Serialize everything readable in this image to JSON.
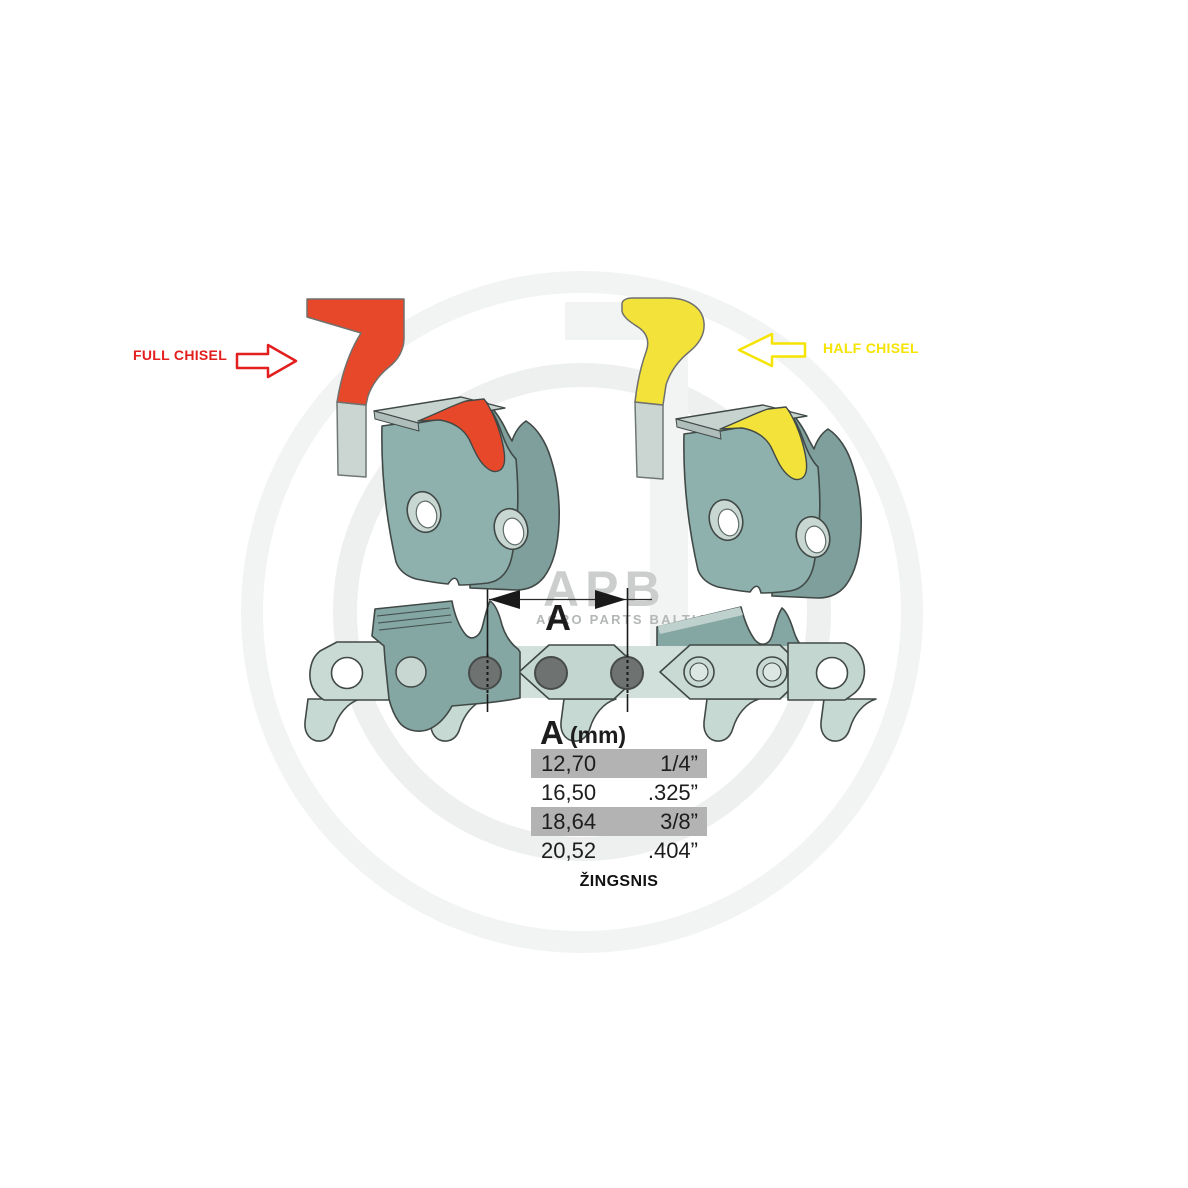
{
  "labels": {
    "full_chisel": "FULL CHISEL",
    "half_chisel": "HALF CHISEL",
    "dimension": "A",
    "pitch_caption": "ŽINGSNIS"
  },
  "watermark": {
    "logo": "APB",
    "subtitle": "AGRO PARTS BALTIJA"
  },
  "table": {
    "header": {
      "symbol": "A",
      "unit": "(mm)"
    },
    "columns": [
      "pitch_mm",
      "pitch_inch"
    ],
    "rows": [
      {
        "mm": "12,70",
        "inch": "1/4”",
        "highlighted": true
      },
      {
        "mm": "16,50",
        "inch": ".325”",
        "highlighted": false
      },
      {
        "mm": "18,64",
        "inch": "3/8”",
        "highlighted": true
      },
      {
        "mm": "20,52",
        "inch": ".404”",
        "highlighted": false
      }
    ]
  },
  "colors": {
    "c-red": "#E8482A",
    "c-red-label": "#E31E1E",
    "c-yellow": "#F2E23A",
    "c-yellow-label": "#F5E300",
    "c-teal": "#8FB1AD",
    "c-teal-dark": "#7E9F9B",
    "c-teal-chain": "#85A7A3",
    "c-plate": "#C7D9D3",
    "c-stem": "#CBD6D2",
    "c-rivet": "#6E7271",
    "c-hl": "#B3B3B3"
  }
}
